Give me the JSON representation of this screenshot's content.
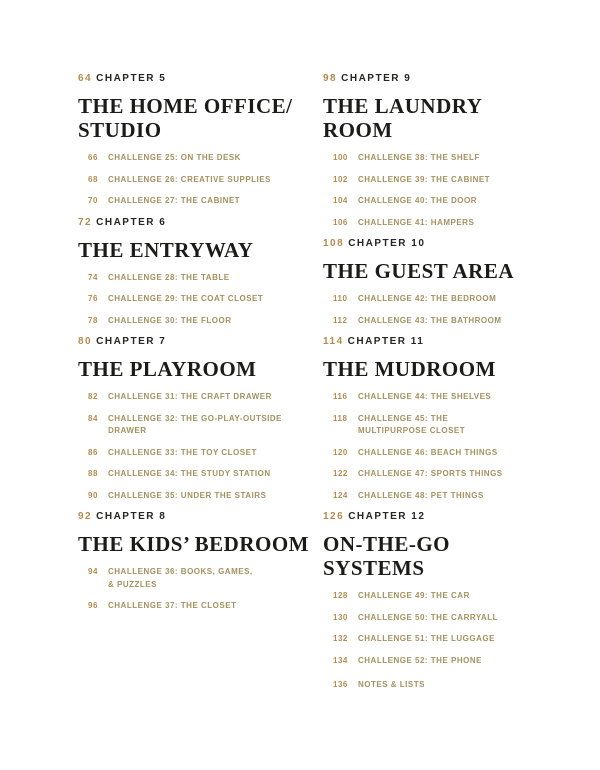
{
  "colors": {
    "page_background": "#ffffff",
    "page_number_gold": "#b28c4e",
    "challenge_text_gold": "#a4915f",
    "heading_dark": "#1b1b19"
  },
  "toc": {
    "columns": [
      {
        "side": "left",
        "chapters": [
          {
            "page": "64",
            "chapter": "CHAPTER 5",
            "title_lines": [
              "THE HOME OFFICE/",
              "STUDIO"
            ],
            "entries": [
              {
                "page": "66",
                "label_lines": [
                  "CHALLENGE 25: ON THE DESK"
                ]
              },
              {
                "page": "68",
                "label_lines": [
                  "CHALLENGE 26: CREATIVE SUPPLIES"
                ]
              },
              {
                "page": "70",
                "label_lines": [
                  "CHALLENGE 27: THE CABINET"
                ]
              }
            ]
          },
          {
            "page": "72",
            "chapter": "CHAPTER 6",
            "title_lines": [
              "THE ENTRYWAY"
            ],
            "entries": [
              {
                "page": "74",
                "label_lines": [
                  "CHALLENGE 28: THE TABLE"
                ]
              },
              {
                "page": "76",
                "label_lines": [
                  "CHALLENGE 29: THE COAT CLOSET"
                ]
              },
              {
                "page": "78",
                "label_lines": [
                  "CHALLENGE 30: THE FLOOR"
                ]
              }
            ]
          },
          {
            "page": "80",
            "chapter": "CHAPTER 7",
            "title_lines": [
              "THE PLAYROOM"
            ],
            "entries": [
              {
                "page": "82",
                "label_lines": [
                  "CHALLENGE 31: THE CRAFT DRAWER"
                ]
              },
              {
                "page": "84",
                "label_lines": [
                  "CHALLENGE 32: THE GO-PLAY-OUTSIDE",
                  "DRAWER"
                ]
              },
              {
                "page": "86",
                "label_lines": [
                  "CHALLENGE 33: THE TOY CLOSET"
                ]
              },
              {
                "page": "88",
                "label_lines": [
                  "CHALLENGE 34: THE STUDY STATION"
                ]
              },
              {
                "page": "90",
                "label_lines": [
                  "CHALLENGE 35: UNDER THE STAIRS"
                ]
              }
            ]
          },
          {
            "page": "92",
            "chapter": "CHAPTER 8",
            "title_lines": [
              "THE KIDS’ BEDROOM"
            ],
            "entries": [
              {
                "page": "94",
                "label_lines": [
                  "CHALLENGE 36: BOOKS, GAMES,",
                  "& PUZZLES"
                ]
              },
              {
                "page": "96",
                "label_lines": [
                  "CHALLENGE 37: THE CLOSET"
                ]
              }
            ]
          }
        ]
      },
      {
        "side": "right",
        "chapters": [
          {
            "page": "98",
            "chapter": "CHAPTER 9",
            "title_lines": [
              "THE LAUNDRY",
              "ROOM"
            ],
            "entries": [
              {
                "page": "100",
                "label_lines": [
                  "CHALLENGE 38: THE SHELF"
                ]
              },
              {
                "page": "102",
                "label_lines": [
                  "CHALLENGE 39: THE CABINET"
                ]
              },
              {
                "page": "104",
                "label_lines": [
                  "CHALLENGE 40: THE DOOR"
                ]
              },
              {
                "page": "106",
                "label_lines": [
                  "CHALLENGE 41: HAMPERS"
                ]
              }
            ]
          },
          {
            "page": "108",
            "chapter": "CHAPTER 10",
            "title_lines": [
              "THE GUEST AREA"
            ],
            "entries": [
              {
                "page": "110",
                "label_lines": [
                  "CHALLENGE 42: THE BEDROOM"
                ]
              },
              {
                "page": "112",
                "label_lines": [
                  "CHALLENGE 43: THE BATHROOM"
                ]
              }
            ]
          },
          {
            "page": "114",
            "chapter": "CHAPTER 11",
            "title_lines": [
              "THE MUDROOM"
            ],
            "entries": [
              {
                "page": "116",
                "label_lines": [
                  "CHALLENGE 44: THE SHELVES"
                ]
              },
              {
                "page": "118",
                "label_lines": [
                  "CHALLENGE 45: THE",
                  "MULTIPURPOSE CLOSET"
                ]
              },
              {
                "page": "120",
                "label_lines": [
                  "CHALLENGE 46: BEACH THINGS"
                ]
              },
              {
                "page": "122",
                "label_lines": [
                  "CHALLENGE 47: SPORTS THINGS"
                ]
              },
              {
                "page": "124",
                "label_lines": [
                  "CHALLENGE 48: PET THINGS"
                ]
              }
            ]
          },
          {
            "page": "126",
            "chapter": "CHAPTER 12",
            "title_lines": [
              "ON-THE-GO",
              "SYSTEMS"
            ],
            "entries": [
              {
                "page": "128",
                "label_lines": [
                  "CHALLENGE 49: THE CAR"
                ]
              },
              {
                "page": "130",
                "label_lines": [
                  "CHALLENGE 50: THE CARRYALL"
                ]
              },
              {
                "page": "132",
                "label_lines": [
                  "CHALLENGE 51: THE LUGGAGE"
                ]
              },
              {
                "page": "134",
                "label_lines": [
                  "CHALLENGE 52: THE PHONE"
                ]
              }
            ]
          }
        ]
      }
    ],
    "footer": {
      "page": "136",
      "label": "NOTES & LISTS"
    }
  }
}
